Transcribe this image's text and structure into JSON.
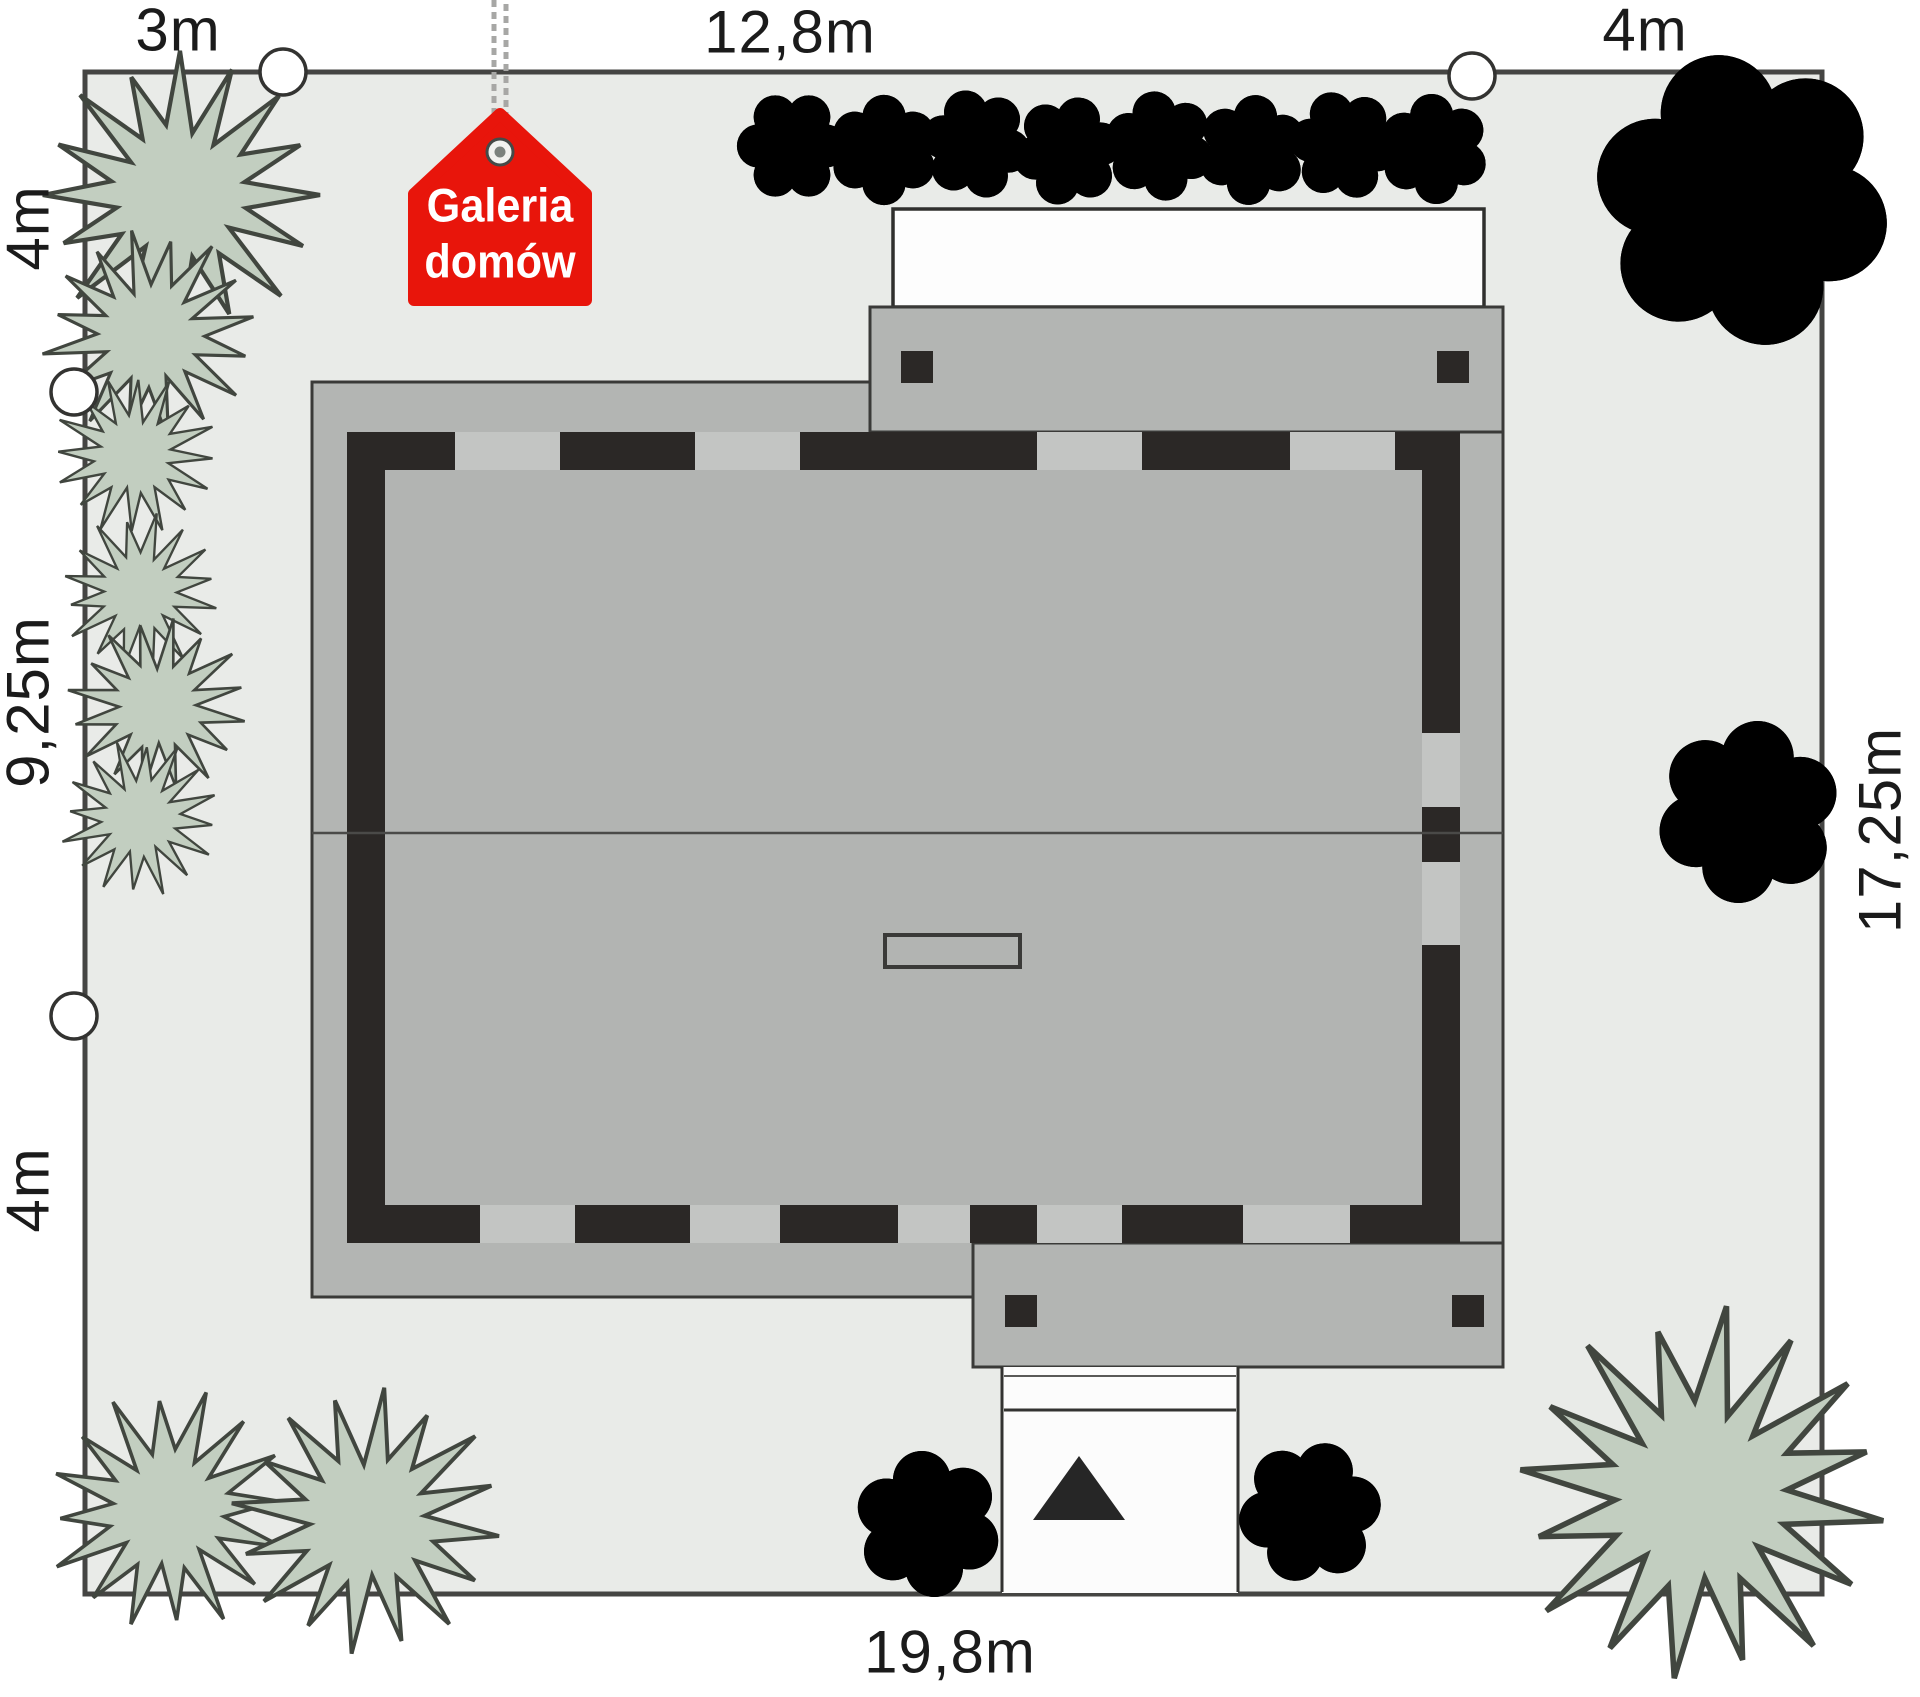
{
  "dimensions": {
    "top_left": "3m",
    "top_center": "12,8m",
    "top_right": "4m",
    "left_top": "4m",
    "left_middle": "9,25m",
    "left_bottom": "4m",
    "right_side": "17,25m",
    "bottom": "19,8m"
  },
  "logo": {
    "line1": "Galeria",
    "line2": "domów"
  },
  "colors": {
    "plot_fill": "#e9ebe8",
    "plot_border": "#454543",
    "roof_gray": "#b3b5b3",
    "wall_dark": "#2b2826",
    "window_gray": "#c3c5c3",
    "tree_fill": "#c2cec0",
    "tree_stroke": "#41463f",
    "paving_white": "#fdfdfd",
    "logo_red": "#e8150b",
    "text": "#1b1b1b"
  }
}
